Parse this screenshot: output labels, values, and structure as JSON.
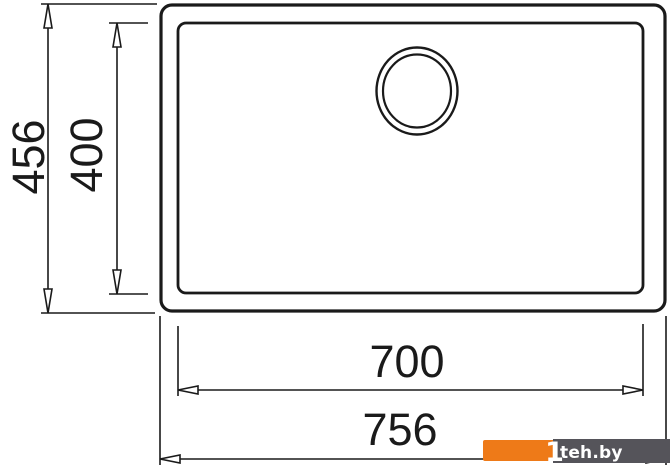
{
  "drawing": {
    "description": "Technical top-view dimension drawing of a rectangular sink bowl with drain hole",
    "line_color": "#1a1a1a",
    "background_color": "#ffffff",
    "dimensions": {
      "overall_height": "456",
      "bowl_height": "400",
      "bowl_width": "700",
      "overall_width": "756"
    }
  },
  "watermark": {
    "text": "teh.by",
    "logo_glyph": "1",
    "orange_color": "#ee7a18",
    "bar_color": "#55545a",
    "text_color": "#ffffff"
  }
}
